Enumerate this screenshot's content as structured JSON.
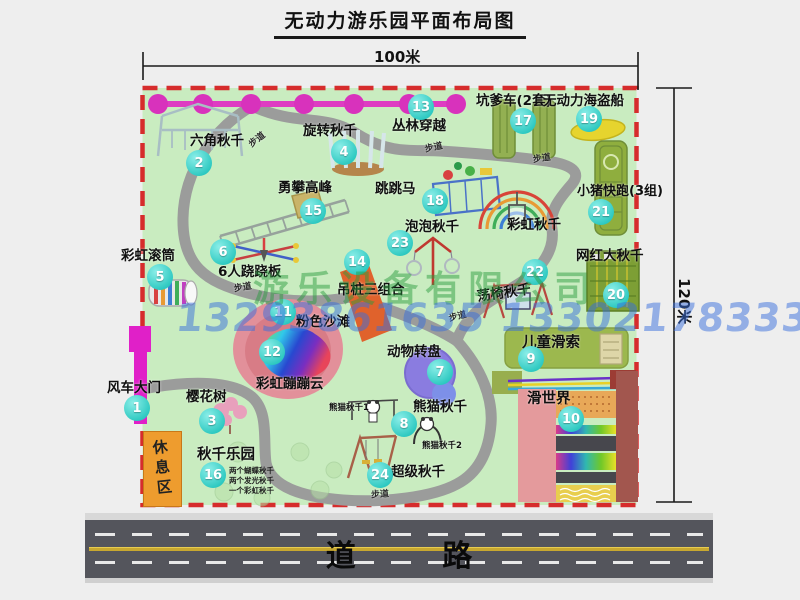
{
  "title": "无动力游乐园平面布局图",
  "dimensions": {
    "width_label": "100米",
    "height_label": "120米"
  },
  "road": {
    "label": "道 路"
  },
  "watermark": {
    "company": "游乐设备有限公司",
    "phone": "13293861635 13302178333"
  },
  "map": {
    "path_label": "步道",
    "rest_area_label": "休息区",
    "rainbow_swing_label": "彩虹秋千",
    "panda_swing_1_label": "熊猫秋千1",
    "panda_swing_2_label": "熊猫秋千2",
    "swing_park_sub": [
      "两个蝴蝶秋千",
      "两个发光秋千",
      "一个彩虹秋千"
    ],
    "items": [
      {
        "id": "1",
        "label": "风车大门"
      },
      {
        "id": "2",
        "label": "六角秋千"
      },
      {
        "id": "3",
        "label": "樱花树"
      },
      {
        "id": "4",
        "label": "旋转秋千"
      },
      {
        "id": "5",
        "label": "彩虹滚筒"
      },
      {
        "id": "6",
        "label": "6人跷跷板"
      },
      {
        "id": "7",
        "label": "动物转盘"
      },
      {
        "id": "8",
        "label": "熊猫秋千"
      },
      {
        "id": "9",
        "label": "儿童滑索"
      },
      {
        "id": "10",
        "label": "滑世界"
      },
      {
        "id": "11",
        "label": "粉色沙滩"
      },
      {
        "id": "12",
        "label": "彩虹蹦蹦云"
      },
      {
        "id": "13",
        "label": "丛林穿越"
      },
      {
        "id": "14",
        "label": "吊桩三组合"
      },
      {
        "id": "15",
        "label": "勇攀高峰"
      },
      {
        "id": "16",
        "label": "秋千乐园"
      },
      {
        "id": "17",
        "label": "坑爹车(2套)"
      },
      {
        "id": "18",
        "label": "跳跳马"
      },
      {
        "id": "19",
        "label": "无动力海盗船"
      },
      {
        "id": "20",
        "label": "网红大秋千"
      },
      {
        "id": "21",
        "label": "小猪快跑(3组)"
      },
      {
        "id": "22",
        "label": "荡椅秋千"
      },
      {
        "id": "23",
        "label": "泡泡秋千"
      },
      {
        "id": "24",
        "label": "超级秋千"
      }
    ],
    "colors": {
      "map_green": "#c9ecc0",
      "border_red": "#d62c2c",
      "badge_teal": "#2cc8c0",
      "chain_magenta": "#de3cc2",
      "gate_magenta": "#e020c8",
      "rest_orange": "#ee9c2e",
      "road_gray": "#54555c"
    }
  }
}
